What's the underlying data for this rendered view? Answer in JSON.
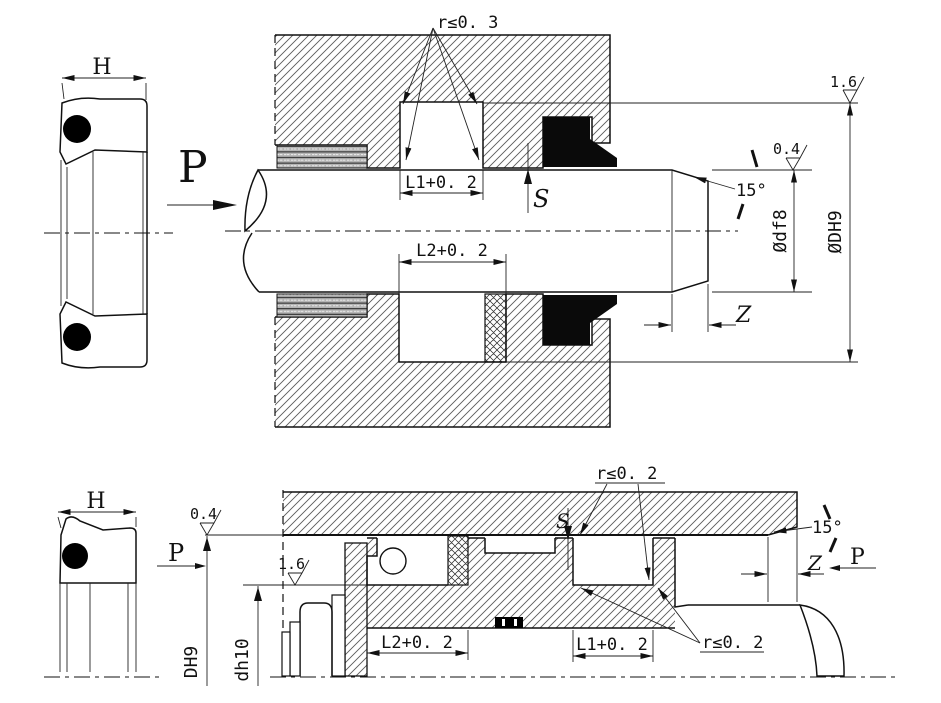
{
  "drawing": {
    "background": "#ffffff",
    "line_color": "#111111",
    "seal_fill": "crosshatch",
    "oring_color": "#000000",
    "wiper_color": "#0a0a0a"
  },
  "top_view": {
    "h_dim": "H",
    "pressure_label": "P",
    "radius_note": "r≤0. 3",
    "groove1_dim": "L1+0. 2",
    "groove2_dim": "L2+0. 2",
    "clearance_label": "S",
    "finish_groove_root": "1.6",
    "finish_rod": "0.4",
    "chamfer_angle": "15°",
    "rod_diameter": "Ødf8",
    "groove_diameter": "ØDH9",
    "chamfer_length": "Z"
  },
  "bottom_view": {
    "h_dim": "H",
    "finish_bore": "0.4",
    "pressure_left": "P",
    "finish_groove_root": "1.6",
    "bore_diameter": "DH9",
    "groove_diameter": "dh10",
    "radius_note_top": "r≤0. 2",
    "radius_note_bottom": "r≤0. 2",
    "clearance_label": "S",
    "chamfer_angle": "15°",
    "chamfer_length": "Z",
    "pressure_right": "P",
    "groove1_dim": "L1+0. 2",
    "groove2_dim": "L2+0. 2"
  }
}
